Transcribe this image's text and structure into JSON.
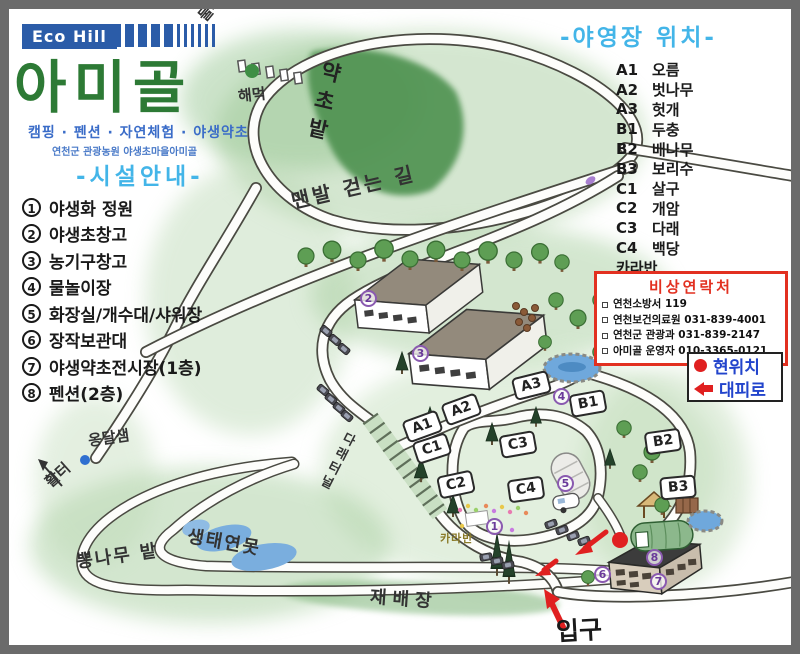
{
  "header": {
    "logo": "Eco Hill",
    "title": "아미골",
    "subtitle": "캠핑 · 펜션 · 자연체험 · 야생약초",
    "subtitle2": "연천군 관광농원 야생초마을아미골"
  },
  "facilities": {
    "heading": "-시설안내-",
    "items": [
      {
        "num": "1",
        "label": "야생화 정원"
      },
      {
        "num": "2",
        "label": "야생초창고"
      },
      {
        "num": "3",
        "label": "농기구창고"
      },
      {
        "num": "4",
        "label": "물놀이장"
      },
      {
        "num": "5",
        "label": "화장실/개수대/샤워장"
      },
      {
        "num": "6",
        "label": "장작보관대"
      },
      {
        "num": "7",
        "label": "야생약초전시장(1층)"
      },
      {
        "num": "8",
        "label": "펜션(2층)"
      }
    ]
  },
  "sites": {
    "heading": "-야영장 위치-",
    "items": [
      {
        "code": "A1",
        "name": "오름"
      },
      {
        "code": "A2",
        "name": "벗나무"
      },
      {
        "code": "A3",
        "name": "헛개"
      },
      {
        "code": "B1",
        "name": "두충"
      },
      {
        "code": "B2",
        "name": "배나무"
      },
      {
        "code": "B3",
        "name": "보리수"
      },
      {
        "code": "C1",
        "name": "살구"
      },
      {
        "code": "C2",
        "name": "개암"
      },
      {
        "code": "C3",
        "name": "다래"
      },
      {
        "code": "C4",
        "name": "백당"
      },
      {
        "code": "",
        "name": "카라반"
      }
    ]
  },
  "emergency": {
    "title": "비상연락처",
    "contacts": [
      "연천소방서 119",
      "연천보건의료원 031-839-4001",
      "연천군 관광과 031-839-2147",
      "아미골 운영자 010-3365-0121"
    ]
  },
  "legend": {
    "current_location": "현위치",
    "evacuation_route": "대피로"
  },
  "map_labels": {
    "trail": "둘레길",
    "hammock": "해먹",
    "herb_field": "약초밭",
    "barefoot_path": "맨발 걷는 길",
    "darae_tunnel": "다래터널",
    "caravan": "카라반",
    "spring": "옹달샘",
    "archery": "활터",
    "mulberry_field": "뽕나무 밭",
    "eco_pond": "생태연못",
    "cultivation": "재배장",
    "entrance": "입구"
  },
  "markers": [
    "A1",
    "A2",
    "A3",
    "B1",
    "B2",
    "B3",
    "C1",
    "C2",
    "C3",
    "C4"
  ],
  "colors": {
    "brand_blue": "#2b5ca8",
    "title_green": "#2d7a35",
    "heading_cyan": "#43b5e8",
    "subtitle_blue": "#3a6cc8",
    "alert_red": "#e23020",
    "legend_text_blue": "#2244cc",
    "map_number_purple": "#8a5ab0",
    "herb_field_green": "#4d9150",
    "pond_blue": "#6fa8dc",
    "frame_gray": "#6b6b6b"
  }
}
